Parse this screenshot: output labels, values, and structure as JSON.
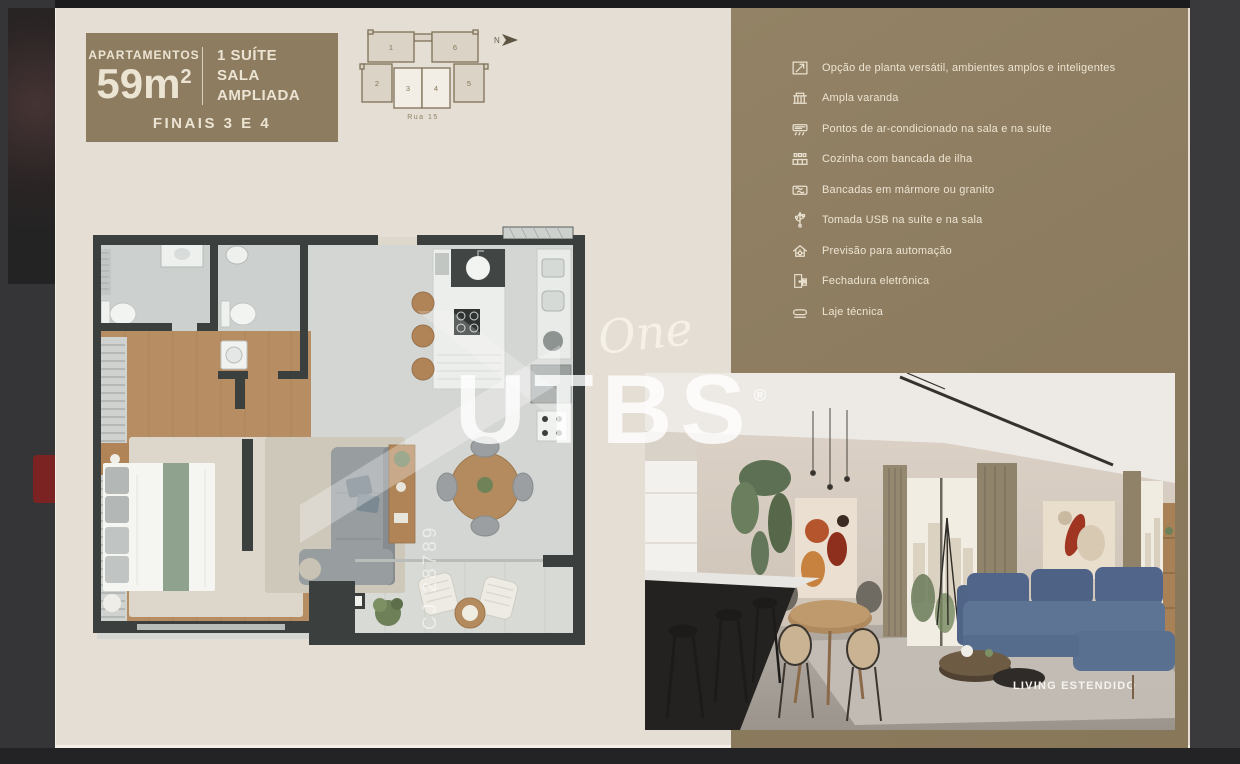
{
  "badge": {
    "apartments_label": "APARTAMENTOS",
    "area_value": "59m",
    "area_exponent": "2",
    "suite_line": "1 SUÍTE",
    "sala_line": "SALA AMPLIADA",
    "finals_line": "FINAIS 3 E 4"
  },
  "key_plan": {
    "north_label": "N",
    "street_label": "Rua 15",
    "unit_labels": [
      "1",
      "2",
      "3",
      "4",
      "5",
      "6"
    ]
  },
  "features": {
    "items": [
      {
        "icon": "floor-plan-arrow-icon",
        "label": "Opção de planta versátil, ambientes amplos e inteligentes"
      },
      {
        "icon": "balcony-icon",
        "label": "Ampla varanda"
      },
      {
        "icon": "air-conditioner-icon",
        "label": "Pontos de ar-condicionado na sala e na suíte"
      },
      {
        "icon": "kitchen-island-icon",
        "label": "Cozinha com bancada de ilha"
      },
      {
        "icon": "marble-countertop-icon",
        "label": "Bancadas em mármore ou granito"
      },
      {
        "icon": "usb-icon",
        "label": "Tomada USB na suíte e na sala"
      },
      {
        "icon": "home-automation-icon",
        "label": "Previsão para automação"
      },
      {
        "icon": "electronic-lock-icon",
        "label": "Fechadura eletrônica"
      },
      {
        "icon": "technical-slab-icon",
        "label": "Laje técnica"
      }
    ]
  },
  "watermarks": {
    "script_word": "One",
    "brand": "UTBS",
    "registered_mark": "®",
    "license_code": "CJ 28789"
  },
  "photo": {
    "caption": "LIVING ESTENDIDO"
  },
  "colors": {
    "card_background": "#e5ded4",
    "panel_brown": "#8d7c60",
    "cream_text": "#ece4d3",
    "plan_wall": "#3b3f3d",
    "bedroom_wood": "#b78e63",
    "bed_green": "#8fa28d",
    "sofa_blue": "#5d7494",
    "sidebar_red": "#7b2222"
  }
}
